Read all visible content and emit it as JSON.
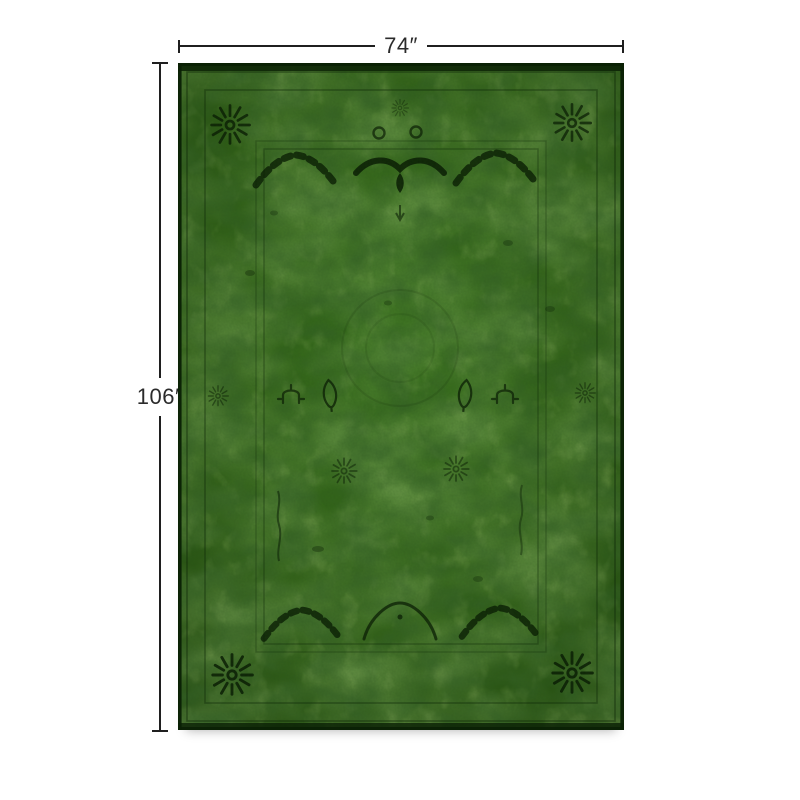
{
  "page": {
    "background_color": "#ffffff"
  },
  "annotations": {
    "width": {
      "label": "74″"
    },
    "height": {
      "label": "106″"
    },
    "line_color": "#1f1f1f",
    "label_color": "#2b2b2b"
  },
  "product_image": {
    "name": "overdyed-green-area-rug",
    "description": "traditional persian-style overdyed rug, green with faded dark motifs",
    "colors": {
      "field_green": "#2d5918",
      "highlight_green": "#4c8227",
      "shadow_green": "#1f430e",
      "motif_dark": "#081a03",
      "edge_dark": "#0a2105"
    }
  }
}
